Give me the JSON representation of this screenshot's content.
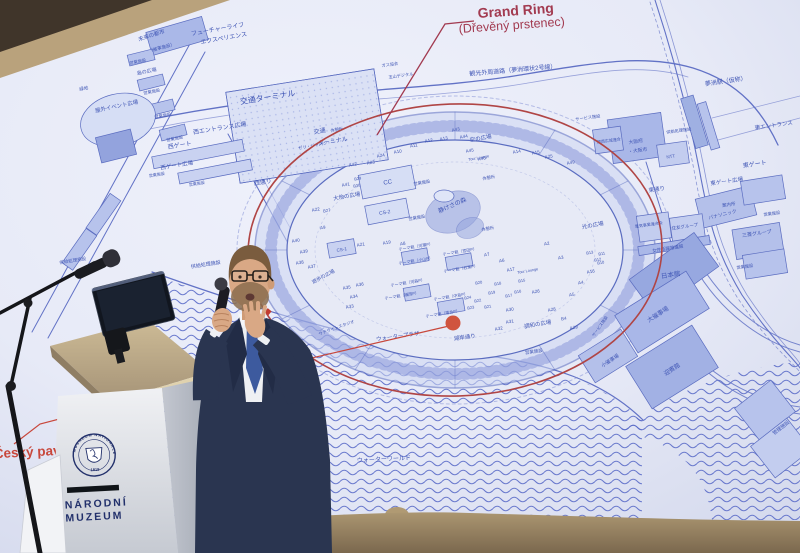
{
  "slide": {
    "title": {
      "main": "Grand Ring",
      "sub": "(Dřevěný prstenec)",
      "color": "#a23a50"
    },
    "czech": {
      "label": "Český pavilon",
      "color": "#c8473b",
      "marker_color": "#d0543e"
    },
    "map": {
      "ink": "#5a6cc4",
      "label_color": "#3f55b5",
      "building_fill": "#bfc9ee",
      "ring_highlight": "#b04545",
      "labels": [
        {
          "t": "フューチャーライフ",
          "x": 218,
          "y": 31,
          "s": 6,
          "r": -10
        },
        {
          "t": "エクスペリエンス",
          "x": 224,
          "y": 40,
          "s": 6,
          "r": -10
        },
        {
          "t": "未来の都市",
          "x": 152,
          "y": 37,
          "s": 5.5,
          "r": -18
        },
        {
          "t": "（催事施設）",
          "x": 162,
          "y": 49,
          "s": 4.5,
          "r": -15
        },
        {
          "t": "営業施設",
          "x": 138,
          "y": 63,
          "s": 4.2,
          "r": -12
        },
        {
          "t": "島の広場",
          "x": 147,
          "y": 73,
          "s": 5,
          "r": -12
        },
        {
          "t": "営業施設",
          "x": 152,
          "y": 93,
          "s": 4.2,
          "r": -12
        },
        {
          "t": "営業施設",
          "x": 163,
          "y": 117,
          "s": 4.2,
          "r": -12
        },
        {
          "t": "営業施設",
          "x": 175,
          "y": 140,
          "s": 4.2,
          "r": -12
        },
        {
          "t": "交通ターミナル",
          "x": 268,
          "y": 100,
          "s": 8,
          "r": -9
        },
        {
          "t": "交通",
          "x": 320,
          "y": 133,
          "s": 6,
          "r": -9
        },
        {
          "t": "ターミナル",
          "x": 333,
          "y": 143,
          "s": 6,
          "r": -9
        },
        {
          "t": "西エントランス広場",
          "x": 220,
          "y": 130,
          "s": 6,
          "r": -9
        },
        {
          "t": "西ゲート",
          "x": 180,
          "y": 147,
          "s": 6,
          "r": -9
        },
        {
          "t": "西ゲート広場",
          "x": 177,
          "y": 167,
          "s": 5.5,
          "r": -9
        },
        {
          "t": "営業施設",
          "x": 157,
          "y": 176,
          "s": 4,
          "r": -9
        },
        {
          "t": "営業施設",
          "x": 197,
          "y": 185,
          "s": 4,
          "r": -9
        },
        {
          "t": "西通り",
          "x": 263,
          "y": 184,
          "s": 6,
          "r": -9
        },
        {
          "t": "屋外イベント広場",
          "x": 117,
          "y": 108,
          "s": 5.5,
          "r": -12
        },
        {
          "t": "緑地",
          "x": 84,
          "y": 90,
          "s": 4.5,
          "r": -12
        },
        {
          "t": "供給処理施設",
          "x": 206,
          "y": 266,
          "s": 5,
          "r": -9
        },
        {
          "t": "供給処理施設",
          "x": 73,
          "y": 262,
          "s": 4.5,
          "r": -9
        },
        {
          "t": "観光外周道路（夢洲環状2号線）",
          "x": 513,
          "y": 72,
          "s": 6,
          "r": -5
        },
        {
          "t": "ガス協会",
          "x": 390,
          "y": 66,
          "s": 4.2,
          "r": -8
        },
        {
          "t": "玉山デジタル",
          "x": 401,
          "y": 77,
          "s": 4.2,
          "r": -8
        },
        {
          "t": "夢洲駅（仮称）",
          "x": 726,
          "y": 83,
          "s": 6,
          "r": -8
        },
        {
          "t": "東エントランス",
          "x": 774,
          "y": 127,
          "s": 5.5,
          "r": -8
        },
        {
          "t": "東ゲート",
          "x": 755,
          "y": 166,
          "s": 6,
          "r": -8
        },
        {
          "t": "東ゲート広場",
          "x": 727,
          "y": 183,
          "s": 5.5,
          "r": -8
        },
        {
          "t": "東通り",
          "x": 657,
          "y": 191,
          "s": 5.5,
          "r": -8
        },
        {
          "t": "案内所",
          "x": 729,
          "y": 206,
          "s": 4.5,
          "r": -8
        },
        {
          "t": "パナソニック",
          "x": 723,
          "y": 216,
          "s": 4.8,
          "r": -14
        },
        {
          "t": "電気事業連合会",
          "x": 649,
          "y": 226,
          "s": 4,
          "r": -8
        },
        {
          "t": "住友グループ",
          "x": 685,
          "y": 228,
          "s": 4.5,
          "r": -8
        },
        {
          "t": "三菱グループ",
          "x": 757,
          "y": 235,
          "s": 5,
          "r": -8
        },
        {
          "t": "女性活躍推進館",
          "x": 668,
          "y": 250,
          "s": 4.5,
          "r": -9
        },
        {
          "t": "日本館",
          "x": 671,
          "y": 277,
          "s": 6.5,
          "r": -9
        },
        {
          "t": "NTT",
          "x": 671,
          "y": 158,
          "s": 4.5,
          "r": -8
        },
        {
          "t": "大阪府",
          "x": 636,
          "y": 143,
          "s": 4.8,
          "r": -8
        },
        {
          "t": "・大阪市",
          "x": 638,
          "y": 152,
          "s": 4.8,
          "r": -8
        },
        {
          "t": "関西広域連合",
          "x": 609,
          "y": 142,
          "s": 4,
          "r": -8
        },
        {
          "t": "供給処理施設",
          "x": 679,
          "y": 132,
          "s": 4.2,
          "r": -8
        },
        {
          "t": "サービス施設",
          "x": 588,
          "y": 119,
          "s": 4.2,
          "r": -8
        },
        {
          "t": "営業施設",
          "x": 772,
          "y": 215,
          "s": 4.2,
          "r": -8
        },
        {
          "t": "営業施設",
          "x": 745,
          "y": 268,
          "s": 4.2,
          "r": -8
        },
        {
          "t": "営業施設",
          "x": 534,
          "y": 353,
          "s": 4.5,
          "r": -8
        },
        {
          "t": "大催事場",
          "x": 659,
          "y": 316,
          "s": 6,
          "r": -33
        },
        {
          "t": "小催事場",
          "x": 611,
          "y": 362,
          "s": 5,
          "r": -33
        },
        {
          "t": "迎賓館",
          "x": 673,
          "y": 371,
          "s": 6,
          "r": -33
        },
        {
          "t": "管理施設",
          "x": 782,
          "y": 429,
          "s": 5,
          "r": -38
        },
        {
          "t": "サービス施設",
          "x": 601,
          "y": 327,
          "s": 4,
          "r": -55
        },
        {
          "t": "休憩所",
          "x": 337,
          "y": 131,
          "s": 4.2,
          "r": -10
        },
        {
          "t": "ゼリ・ジャパン",
          "x": 313,
          "y": 147,
          "s": 4.2,
          "r": -10
        },
        {
          "t": "空の広場",
          "x": 481,
          "y": 140,
          "s": 5.5,
          "r": -10
        },
        {
          "t": "大地の広場",
          "x": 347,
          "y": 198,
          "s": 5.5,
          "r": -10
        },
        {
          "t": "静けさの森",
          "x": 453,
          "y": 207,
          "s": 6,
          "r": -24
        },
        {
          "t": "休憩所",
          "x": 489,
          "y": 179,
          "s": 4.2,
          "r": -10
        },
        {
          "t": "休憩所",
          "x": 488,
          "y": 230,
          "s": 4.2,
          "r": -10
        },
        {
          "t": "営業施設",
          "x": 422,
          "y": 184,
          "s": 4.2,
          "r": -10
        },
        {
          "t": "営業施設",
          "x": 417,
          "y": 219,
          "s": 4.2,
          "r": -10
        },
        {
          "t": "CC",
          "x": 388,
          "y": 184,
          "s": 6,
          "r": -10
        },
        {
          "t": "CS-2",
          "x": 385,
          "y": 214,
          "s": 5,
          "r": -10
        },
        {
          "t": "CS-1",
          "x": 342,
          "y": 251,
          "s": 4.5,
          "r": -10
        },
        {
          "t": "光の広場",
          "x": 593,
          "y": 227,
          "s": 5.5,
          "r": -10
        },
        {
          "t": "調和の広場",
          "x": 538,
          "y": 326,
          "s": 5.5,
          "r": -10
        },
        {
          "t": "遊歩の広場",
          "x": 324,
          "y": 278,
          "s": 5,
          "r": -28
        },
        {
          "t": "湖岸通り",
          "x": 465,
          "y": 339,
          "s": 5.5,
          "r": -8
        },
        {
          "t": "ウォータープラザ",
          "x": 398,
          "y": 338,
          "s": 5.5,
          "r": -8
        },
        {
          "t": "ウォーターワールド",
          "x": 384,
          "y": 461,
          "s": 6,
          "r": -3
        },
        {
          "t": "サテライトスタジオ",
          "x": 337,
          "y": 329,
          "s": 4.2,
          "r": -20
        },
        {
          "t": "Tour Lounge",
          "x": 528,
          "y": 272,
          "s": 3.8,
          "r": -10
        },
        {
          "t": "Tour Lounge",
          "x": 479,
          "y": 159,
          "s": 3.8,
          "r": -10
        },
        {
          "t": "A40",
          "x": 296,
          "y": 242,
          "s": 4.5,
          "r": -10
        },
        {
          "t": "A39",
          "x": 304,
          "y": 253,
          "s": 4.5,
          "r": -10
        },
        {
          "t": "A38",
          "x": 300,
          "y": 264,
          "s": 4.5,
          "r": -10
        },
        {
          "t": "A37",
          "x": 312,
          "y": 268,
          "s": 4.5,
          "r": -10
        },
        {
          "t": "A21",
          "x": 361,
          "y": 246,
          "s": 4.5,
          "r": -10
        },
        {
          "t": "A35",
          "x": 347,
          "y": 289,
          "s": 4.5,
          "r": -10
        },
        {
          "t": "A36",
          "x": 360,
          "y": 286,
          "s": 4.5,
          "r": -10
        },
        {
          "t": "A34",
          "x": 354,
          "y": 298,
          "s": 4.5,
          "r": -10
        },
        {
          "t": "A33",
          "x": 350,
          "y": 308,
          "s": 4.5,
          "r": -10
        },
        {
          "t": "A19",
          "x": 387,
          "y": 244,
          "s": 4.5,
          "r": -10
        },
        {
          "t": "A8",
          "x": 403,
          "y": 245,
          "s": 4.5,
          "r": -10
        },
        {
          "t": "A7",
          "x": 487,
          "y": 256,
          "s": 4.5,
          "r": -10
        },
        {
          "t": "A6",
          "x": 502,
          "y": 262,
          "s": 4.5,
          "r": -10
        },
        {
          "t": "A5",
          "x": 572,
          "y": 296,
          "s": 4.5,
          "r": -10
        },
        {
          "t": "A4",
          "x": 581,
          "y": 284,
          "s": 4.5,
          "r": -10
        },
        {
          "t": "A3",
          "x": 561,
          "y": 259,
          "s": 4.5,
          "r": -10
        },
        {
          "t": "A2",
          "x": 547,
          "y": 245,
          "s": 4.5,
          "r": -10
        },
        {
          "t": "A17",
          "x": 511,
          "y": 271,
          "s": 4.5,
          "r": -10
        },
        {
          "t": "A16",
          "x": 591,
          "y": 273,
          "s": 4.5,
          "r": -10
        },
        {
          "t": "A15",
          "x": 536,
          "y": 154,
          "s": 4.5,
          "r": -10
        },
        {
          "t": "A14",
          "x": 517,
          "y": 153,
          "s": 4.5,
          "r": -10
        },
        {
          "t": "A25",
          "x": 549,
          "y": 158,
          "s": 4.5,
          "r": -10
        },
        {
          "t": "A26",
          "x": 536,
          "y": 293,
          "s": 4.5,
          "r": -10
        },
        {
          "t": "A28",
          "x": 552,
          "y": 311,
          "s": 4.5,
          "r": -10
        },
        {
          "t": "A29",
          "x": 574,
          "y": 329,
          "s": 4.5,
          "r": -10
        },
        {
          "t": "A30",
          "x": 510,
          "y": 311,
          "s": 4.5,
          "r": -10
        },
        {
          "t": "A31",
          "x": 510,
          "y": 323,
          "s": 4.5,
          "r": -10
        },
        {
          "t": "A32",
          "x": 499,
          "y": 330,
          "s": 4.5,
          "r": -10
        },
        {
          "t": "B4",
          "x": 564,
          "y": 320,
          "s": 4.5,
          "r": -10
        },
        {
          "t": "A9",
          "x": 323,
          "y": 229,
          "s": 4.5,
          "r": -10
        },
        {
          "t": "A22",
          "x": 316,
          "y": 211,
          "s": 4.5,
          "r": -10
        },
        {
          "t": "B27",
          "x": 327,
          "y": 212,
          "s": 4.2,
          "r": -10
        },
        {
          "t": "A42",
          "x": 353,
          "y": 166,
          "s": 4.5,
          "r": -10
        },
        {
          "t": "A23",
          "x": 371,
          "y": 164,
          "s": 4.5,
          "r": -10
        },
        {
          "t": "A24",
          "x": 381,
          "y": 157,
          "s": 4.5,
          "r": -10
        },
        {
          "t": "A10",
          "x": 398,
          "y": 153,
          "s": 4.5,
          "r": -10
        },
        {
          "t": "A11",
          "x": 414,
          "y": 147,
          "s": 4.5,
          "r": -10
        },
        {
          "t": "A12",
          "x": 429,
          "y": 142,
          "s": 4.5,
          "r": -10
        },
        {
          "t": "A13",
          "x": 444,
          "y": 140,
          "s": 4.5,
          "r": -10
        },
        {
          "t": "A43",
          "x": 456,
          "y": 131,
          "s": 4.5,
          "r": -10
        },
        {
          "t": "A44",
          "x": 464,
          "y": 138,
          "s": 4.5,
          "r": -10
        },
        {
          "t": "A45",
          "x": 470,
          "y": 152,
          "s": 4.5,
          "r": -10
        },
        {
          "t": "A46",
          "x": 482,
          "y": 160,
          "s": 4.5,
          "r": -10
        },
        {
          "t": "A41",
          "x": 346,
          "y": 186,
          "s": 4.5,
          "r": -10
        },
        {
          "t": "B29",
          "x": 358,
          "y": 180,
          "s": 4,
          "r": -10
        },
        {
          "t": "B30",
          "x": 357,
          "y": 187,
          "s": 4,
          "r": -10
        },
        {
          "t": "A49",
          "x": 571,
          "y": 164,
          "s": 4.5,
          "r": -10
        },
        {
          "t": "B15",
          "x": 522,
          "y": 282,
          "s": 4,
          "r": -10
        },
        {
          "t": "B16",
          "x": 518,
          "y": 293,
          "s": 4,
          "r": -10
        },
        {
          "t": "B17",
          "x": 509,
          "y": 297,
          "s": 4,
          "r": -10
        },
        {
          "t": "B18",
          "x": 498,
          "y": 285,
          "s": 4,
          "r": -10
        },
        {
          "t": "B19",
          "x": 492,
          "y": 294,
          "s": 4,
          "r": -10
        },
        {
          "t": "B20",
          "x": 479,
          "y": 284,
          "s": 4,
          "r": -10
        },
        {
          "t": "B21",
          "x": 488,
          "y": 308,
          "s": 4,
          "r": -10
        },
        {
          "t": "B22",
          "x": 478,
          "y": 302,
          "s": 4,
          "r": -10
        },
        {
          "t": "B23",
          "x": 471,
          "y": 309,
          "s": 4,
          "r": -10
        },
        {
          "t": "B24",
          "x": 468,
          "y": 299,
          "s": 4,
          "r": -10
        },
        {
          "t": "B10",
          "x": 601,
          "y": 264,
          "s": 4,
          "r": -10
        },
        {
          "t": "B11",
          "x": 602,
          "y": 255,
          "s": 4,
          "r": -10
        },
        {
          "t": "B12",
          "x": 598,
          "y": 261,
          "s": 4,
          "r": -10
        },
        {
          "t": "B13",
          "x": 590,
          "y": 254,
          "s": 4,
          "r": -10
        },
        {
          "t": "テーマ館（河瀬P）",
          "x": 416,
          "y": 248,
          "s": 4,
          "r": -10
        },
        {
          "t": "テーマ館（宮田P）",
          "x": 460,
          "y": 253,
          "s": 4,
          "r": -10
        },
        {
          "t": "テーマ館（小山P）",
          "x": 416,
          "y": 262,
          "s": 4,
          "r": -10
        },
        {
          "t": "テーマ館（石黒P）",
          "x": 461,
          "y": 270,
          "s": 4,
          "r": -10
        },
        {
          "t": "テーマ館（河森P）",
          "x": 408,
          "y": 284,
          "s": 4,
          "r": -10
        },
        {
          "t": "テーマ館（福岡P）",
          "x": 402,
          "y": 297,
          "s": 4,
          "r": -10
        },
        {
          "t": "テーマ館（中島P）",
          "x": 451,
          "y": 298,
          "s": 4,
          "r": -10
        },
        {
          "t": "テーマ館（落合P）",
          "x": 443,
          "y": 315,
          "s": 4,
          "r": -10
        }
      ]
    }
  },
  "podium": {
    "seal_top": "MUSAEUM NATIONALE",
    "seal_year": "1818",
    "line1": "NÁRODNÍ",
    "line2": "MUZEUM",
    "text_color": "#212f68"
  }
}
